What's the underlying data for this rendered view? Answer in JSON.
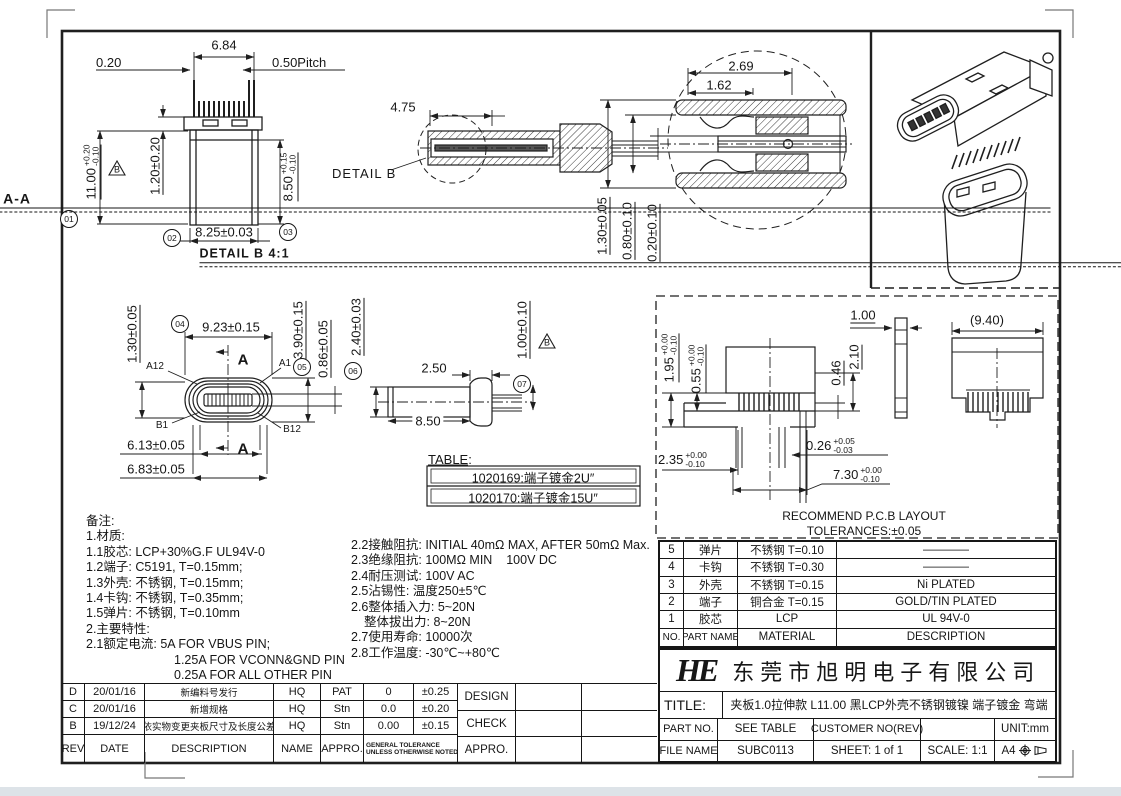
{
  "sheet": {
    "bg_color": "#ffffff",
    "line_color": "#1f1f1f",
    "bottom_bar_color": "#dde3e8"
  },
  "views": {
    "front": {
      "balloon_01": "01",
      "balloon_02": "02",
      "balloon_03": "03",
      "dim_width_top": "6.84",
      "dim_gap": "0.20",
      "dim_pitch": "0.50Pitch",
      "dim_height": {
        "v": "11.00",
        "p": "+0.20",
        "m": "-0.10"
      },
      "dim_flange": "1.20±0.20",
      "dim_shell": {
        "v": "8.50",
        "p": "+0.15",
        "m": "-0.10"
      },
      "dim_body_w": "8.25±0.03",
      "datum": "B"
    },
    "section": {
      "dim_depth": "4.75",
      "detail_label": "DETAIL B",
      "label": "SECTION A-A"
    },
    "detail_b": {
      "label": "DETAIL B 4:1",
      "dim_269": "2.69",
      "dim_162": "1.62",
      "dim_130": "1.30±0.05",
      "dim_080": "0.80±0.10",
      "dim_020": "0.20±0.10"
    },
    "face": {
      "balloon_04": "04",
      "balloon_05": "05",
      "dim_130": "1.30±0.05",
      "dim_923": "9.23±0.15",
      "dim_390": "3.90±0.15",
      "dim_086": "0.86±0.05",
      "dim_613": "6.13±0.05",
      "dim_683": "6.83±0.05",
      "pin_a12": "A12",
      "pin_a1": "A1",
      "pin_b1": "B1",
      "pin_b12": "B12",
      "section_mark": "A"
    },
    "side": {
      "balloon_06": "06",
      "balloon_07": "07",
      "dim_240": "2.40±0.03",
      "dim_250": "2.50",
      "dim_850": "8.50",
      "dim_100": "1.00±0.10",
      "datum": "B"
    },
    "pcb": {
      "dim_195": {
        "v": "1.95",
        "p": "+0.00",
        "m": "-0.10"
      },
      "dim_055": {
        "v": "0.55",
        "p": "+0.00",
        "m": "-0.10"
      },
      "dim_100": "1.00",
      "dim_940": "(9.40)",
      "dim_046": "0.46",
      "dim_210": "2.10",
      "dim_235": {
        "v": "2.35",
        "p": "+0.00",
        "m": "-0.10"
      },
      "dim_026": {
        "v": "0.26",
        "p": "+0.05",
        "m": "-0.03"
      },
      "dim_730": {
        "v": "7.30",
        "p": "+0.00",
        "m": "-0.10"
      },
      "note1": "RECOMMEND P.C.B LAYOUT",
      "note2": "TOLERANCES:±0.05"
    }
  },
  "plating_table": {
    "label": "TABLE:",
    "rows": [
      "1020169:端子镀金2U″",
      "1020170:端子镀金15U″"
    ]
  },
  "notes": {
    "left": [
      "备注:",
      "1.材质:",
      "1.1胶芯: LCP+30%G.F UL94V-0",
      "1.2端子: C5191, T=0.15mm;",
      "1.3外壳: 不锈钢, T=0.15mm;",
      "1.4卡钩: 不锈钢, T=0.35mm;",
      "1.5弹片: 不锈钢, T=0.10mm",
      "2.主要特性:",
      "2.1额定电流: 5A FOR VBUS PIN;",
      "1.25A FOR VCONN&GND PIN",
      "0.25A FOR ALL OTHER PIN"
    ],
    "right": [
      "2.2接触阻抗: INITIAL 40mΩ MAX, AFTER 50mΩ Max.",
      "2.3绝缘阻抗: 100MΩ MIN    100V DC",
      "2.4耐压测试: 100V AC",
      "2.5沾锡性: 温度250±5℃",
      "2.6整体插入力: 5~20N",
      "整体拔出力: 8~20N",
      "2.7使用寿命: 10000次",
      "2.8工作温度: -30℃~+80℃"
    ]
  },
  "parts_table": {
    "headers": {
      "no": "NO.",
      "part": "PART NAME",
      "material": "MATERIAL",
      "desc": "DESCRIPTION"
    },
    "rows": [
      {
        "no": "5",
        "part": "弹片",
        "material": "不锈钢 T=0.10",
        "desc": "————"
      },
      {
        "no": "4",
        "part": "卡钩",
        "material": "不锈钢 T=0.30",
        "desc": "————"
      },
      {
        "no": "3",
        "part": "外壳",
        "material": "不锈钢 T=0.15",
        "desc": "Ni PLATED"
      },
      {
        "no": "2",
        "part": "端子",
        "material": "铜合金 T=0.15",
        "desc": "GOLD/TIN PLATED"
      },
      {
        "no": "1",
        "part": "胶芯",
        "material": "LCP",
        "desc": "UL 94V-0"
      }
    ]
  },
  "title_block": {
    "logo": "HE",
    "company": "东莞市旭明电子有限公司",
    "title_label": "TITLE:",
    "title": "夹板1.0拉伸款 L11.00 黑LCP外壳不锈钢镀镍 端子镀金 弯端",
    "part_no_label": "PART NO.",
    "part_no": "SEE TABLE",
    "customer_label": "CUSTOMER NO(REV)",
    "unit": "UNIT:mm",
    "file_label": "FILE NAME",
    "file_name": "SUBC0113",
    "sheet": "SHEET: 1 of 1",
    "scale": "SCALE: 1:1",
    "paper": "A4"
  },
  "rev_table": {
    "headers": {
      "rev": "REV",
      "date": "DATE",
      "desc": "DESCRIPTION",
      "name": "NAME",
      "appro": "APPRO.",
      "tol1": "GENERAL TOLERANCE",
      "tol2": "UNLESS OTHERWISE NOTED"
    },
    "rows": [
      {
        "rev": "D",
        "date": "20/01/16",
        "desc": "新编料号发行",
        "name": "HQ",
        "appro": "PAT",
        "tol_digit": "0",
        "tol_val": "±0.25"
      },
      {
        "rev": "C",
        "date": "20/01/16",
        "desc": "新增规格",
        "name": "HQ",
        "appro": "Stn",
        "tol_digit": "0.0",
        "tol_val": "±0.20"
      },
      {
        "rev": "B",
        "date": "19/12/24",
        "desc": "依实物变更夹板尺寸及长度公差",
        "name": "HQ",
        "appro": "Stn",
        "tol_digit": "0.00",
        "tol_val": "±0.15"
      }
    ],
    "sign": {
      "design": "DESIGN",
      "check": "CHECK",
      "appro": "APPRO."
    }
  }
}
